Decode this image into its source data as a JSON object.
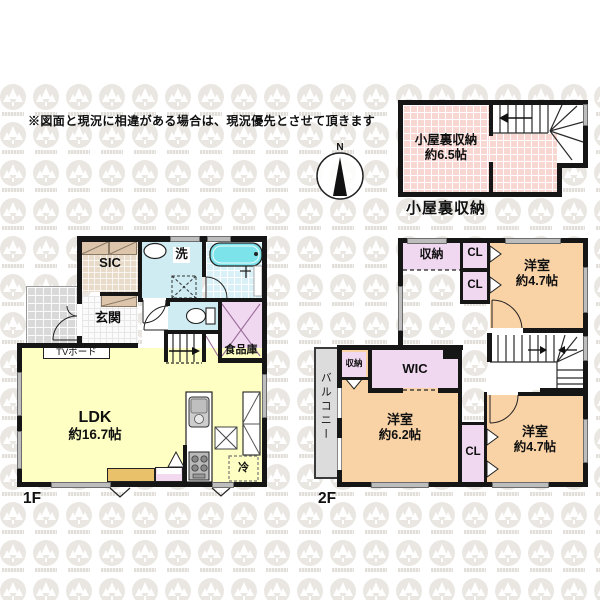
{
  "disclaimer": "※図面と現況に相違がある場合は、現況優先とさせて頂きます",
  "compass": {
    "north": "N"
  },
  "attic": {
    "title": "小屋裏収納",
    "room_name": "小屋裏収納",
    "room_size": "約6.5帖"
  },
  "f1": {
    "floor_label": "1F",
    "sic": "SIC",
    "entrance": "玄関",
    "laundry": "洗",
    "ldk_name": "LDK",
    "ldk_size": "約16.7帖",
    "tv_board": "TVボード",
    "pantry": "食品庫",
    "fridge": "冷"
  },
  "f2": {
    "floor_label": "2F",
    "storage_n": "収納",
    "cl_n1": "CL",
    "cl_n2": "CL",
    "room_ne_name": "洋室",
    "room_ne_size": "約4.7帖",
    "storage_w": "収納",
    "wic": "WIC",
    "room_sw_name": "洋室",
    "room_sw_size": "約6.2帖",
    "cl_s": "CL",
    "room_se_name": "洋室",
    "room_se_size": "約4.7帖",
    "balcony": "バルコニー"
  },
  "colors": {
    "ldk_yellow": "#feffc2",
    "bedroom_peach": "#f9d2a5",
    "closet_lavender": "#f1d8f1",
    "attic_pink": "#f8d6d2",
    "bath_floor": "#d9f1f6",
    "bathtub_cyan": "#7de3eb",
    "balcony_gray": "#d9d9d9",
    "wall_black": "#161616",
    "counter_tan": "#e9c16b"
  }
}
